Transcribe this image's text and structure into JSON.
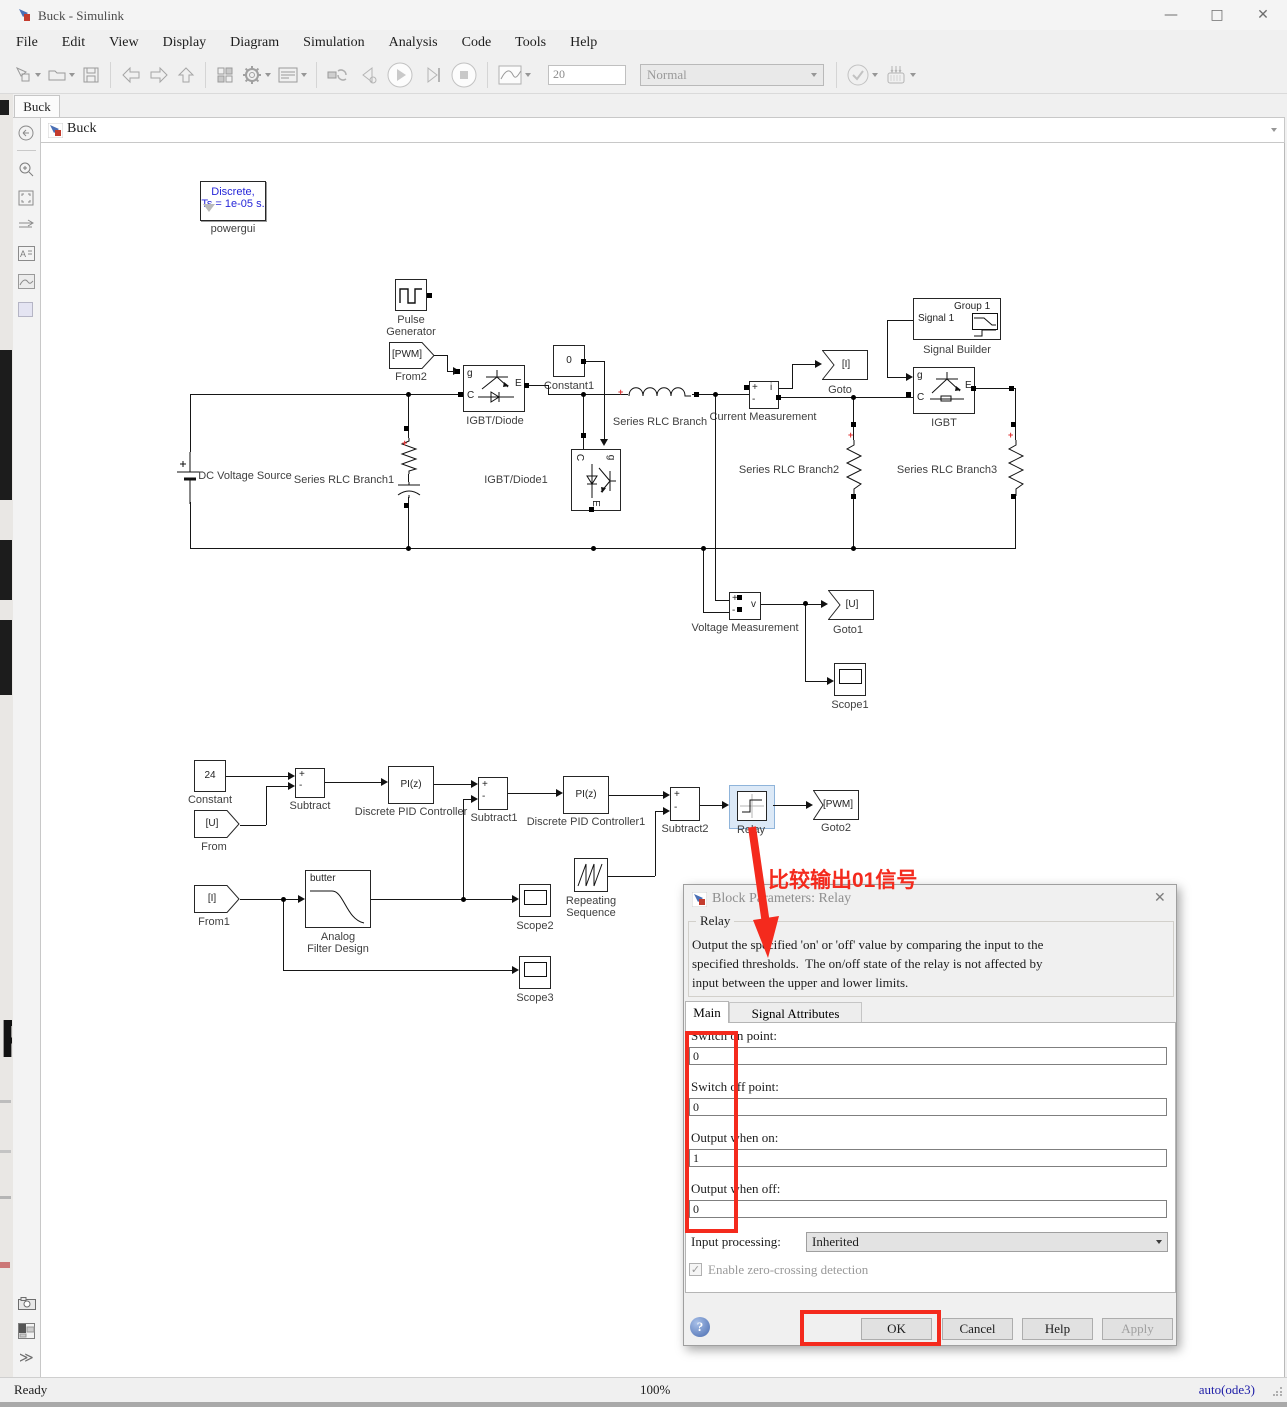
{
  "titlebar": {
    "title": "Buck - Simulink"
  },
  "menu": {
    "items": [
      "File",
      "Edit",
      "View",
      "Display",
      "Diagram",
      "Simulation",
      "Analysis",
      "Code",
      "Tools",
      "Help"
    ]
  },
  "toolbar": {
    "stop_time": "20",
    "mode": "Normal"
  },
  "tab": {
    "label": "Buck"
  },
  "breadcrumb": {
    "label": "Buck"
  },
  "sym": {
    "plus": "+",
    "minus": "-",
    "g": "g",
    "c": "C",
    "e": "E",
    "i": "i",
    "v": "v"
  },
  "blocks": {
    "powergui_l1": "Discrete,",
    "powergui_l2": "Ts = 1e-05 s.",
    "powergui": "powergui",
    "pulse_l1": "Pulse",
    "pulse_l2": "Generator",
    "from2_tag": "[PWM]",
    "from2": "From2",
    "igbtd": "IGBT/Diode",
    "constant1_v": "0",
    "constant1": "Constant1",
    "rlc": "Series RLC Branch",
    "cm": "Current Measurement",
    "goto_tag": "[I]",
    "goto_lbl": "Goto",
    "sb_sig": "Signal 1",
    "sb_grp": "Group 1",
    "sb": "Signal Builder",
    "igbt": "IGBT",
    "dc": "DC Voltage Source",
    "rlc1": "Series RLC Branch1",
    "igbtd1": "IGBT/Diode1",
    "rlc2": "Series RLC Branch2",
    "rlc3": "Series RLC Branch3",
    "vm": "Voltage Measurement",
    "goto1_tag": "[U]",
    "goto1": "Goto1",
    "scope1": "Scope1",
    "const_v": "24",
    "const_lbl": "Constant",
    "from_tag": "[U]",
    "from_lbl": "From",
    "sub": "Subtract",
    "pid_v": "PI(z)",
    "pid": "Discrete PID Controller",
    "sub1": "Subtract1",
    "pid1_v": "PI(z)",
    "pid1": "Discrete PID Controller1",
    "sub2": "Subtract2",
    "relay": "Relay",
    "goto2_tag": "[PWM]",
    "goto2": "Goto2",
    "from1_tag": "[I]",
    "from1": "From1",
    "butter": "butter",
    "afd_l1": "Analog",
    "afd_l2": "Filter Design",
    "scope2": "Scope2",
    "rep_l1": "Repeating",
    "rep_l2": "Sequence",
    "scope3": "Scope3"
  },
  "annotation": {
    "text": "比较输出01信号"
  },
  "dialog": {
    "title": "Block Parameters: Relay",
    "group": "Relay",
    "desc1": "Output the specified 'on' or 'off' value by comparing the input to the",
    "desc2": "specified thresholds.  The on/off state of the relay is not affected by",
    "desc3": "input between the upper and lower limits.",
    "tab_main": "Main",
    "tab_attrs": "Signal Attributes",
    "lbl_switch_on": "Switch on point:",
    "val_switch_on": "0",
    "lbl_switch_off": "Switch off point:",
    "val_switch_off": "0",
    "lbl_out_on": "Output when on:",
    "val_out_on": "1",
    "lbl_out_off": "Output when off:",
    "val_out_off": "0",
    "lbl_input_proc": "Input processing:",
    "val_input_proc": "Inherited",
    "chk_zero": "Enable zero-crossing detection",
    "btn_ok": "OK",
    "btn_cancel": "Cancel",
    "btn_help": "Help",
    "btn_apply": "Apply"
  },
  "status": {
    "ready": "Ready",
    "zoom": "100%",
    "solver": "auto(ode3)"
  }
}
